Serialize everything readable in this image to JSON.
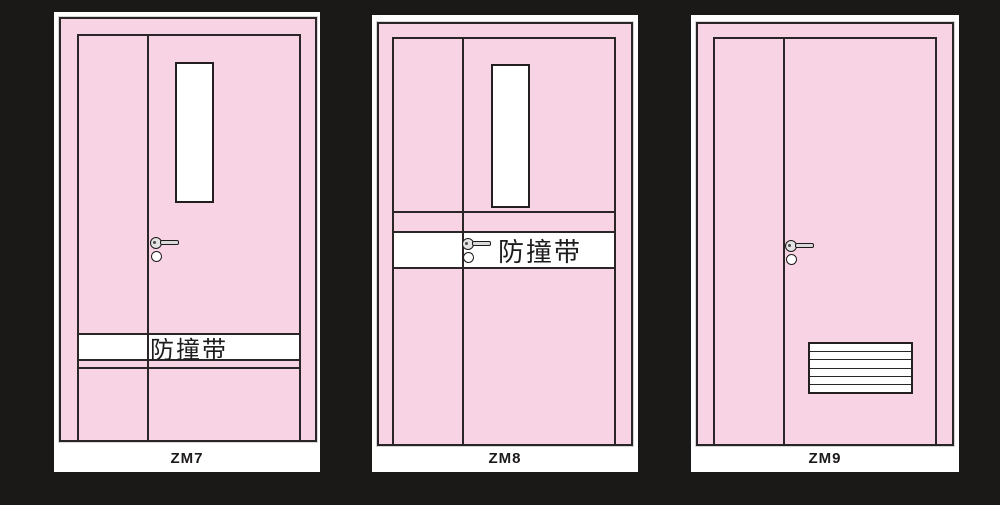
{
  "page": {
    "background_color": "#1b1818",
    "card_color": "#ffffff"
  },
  "palette": {
    "door_pink": "#f7d3e3",
    "outline_black": "#2a2627",
    "hardware_gray": "#e3e3e3",
    "panel_white": "#ffffff"
  },
  "doors": [
    {
      "label": "ZM7",
      "band_text": "防撞带",
      "features": {
        "vision_panel": true,
        "crash_band_position": "low",
        "lever_handle": true,
        "louver_vent": false
      }
    },
    {
      "label": "ZM8",
      "band_text": "防撞带",
      "features": {
        "vision_panel": true,
        "crash_band_position": "middle",
        "lever_handle": true,
        "louver_vent": false
      }
    },
    {
      "label": "ZM9",
      "features": {
        "vision_panel": false,
        "crash_band_position": "none",
        "lever_handle": true,
        "louver_vent": true
      }
    }
  ]
}
